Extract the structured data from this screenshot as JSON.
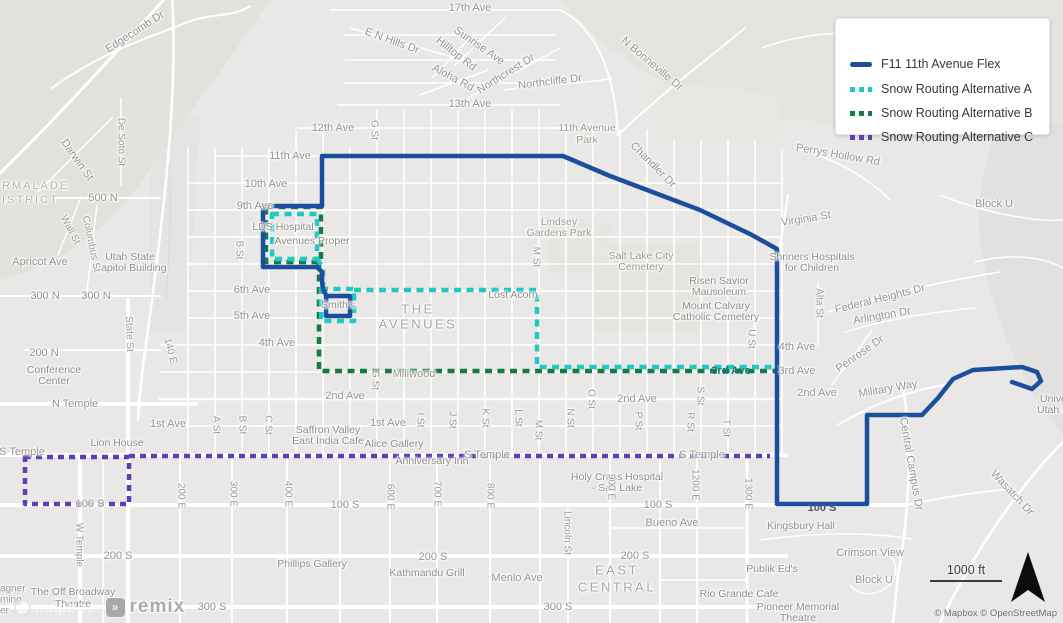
{
  "legend": {
    "items": [
      {
        "label": "F11 11th Avenue Flex",
        "color": "#1b4f9e",
        "style": "solid"
      },
      {
        "label": "Snow Routing Alternative A",
        "color": "#1fc8c2",
        "style": "dashed"
      },
      {
        "label": "Snow Routing Alternative B",
        "color": "#177a44",
        "style": "dashed"
      },
      {
        "label": "Snow Routing Alternative C",
        "color": "#5c3fb0",
        "style": "dashed"
      }
    ]
  },
  "scale_bar": {
    "label": "1000 ft"
  },
  "attribution": {
    "text": "© Mapbox © OpenStreetMap"
  },
  "watermark": {
    "mapbox": "mapbox",
    "remix": "remix",
    "remix_icon": "»"
  },
  "colors": {
    "route_f11": "#1b4f9e",
    "route_alt_a": "#1fc8c2",
    "route_alt_b": "#177a44",
    "route_alt_c": "#5c3fb0",
    "map_base": "#e9e8e6",
    "roads": "#ffffff"
  },
  "routes": [
    {
      "id": "alt-b",
      "name": "Snow Routing Alternative B",
      "color": "#177a44",
      "width": 4.5,
      "dash": "7 5.5",
      "paths": [
        "M266,207 L321,207 L321,262 L266,262 Z",
        "M319,262 L319,371 L775,371"
      ]
    },
    {
      "id": "alt-a",
      "name": "Snow Routing Alternative A",
      "color": "#1fc8c2",
      "width": 4.5,
      "dash": "7 5.5",
      "paths": [
        "M272,214 L317,214 L317,259 L272,259 Z",
        "M317,259 L323,267 L323,289",
        "M321,289 L354,289 L354,321 L321,321 Z",
        "M354,290 L537,290 L537,367 L775,367"
      ]
    },
    {
      "id": "alt-c",
      "name": "Snow Routing Alternative C",
      "color": "#5c3fb0",
      "width": 4.5,
      "dash": "6 5",
      "paths": [
        "M25,457 L129,457 L129,504 L25,504 Z",
        "M129,456 L770,456"
      ]
    },
    {
      "id": "f11",
      "name": "F11 11th Avenue Flex",
      "color": "#1b4f9e",
      "width": 4.5,
      "dash": null,
      "paths": [
        "M327,297 L323,289 L322,281 L322,272 L317,267 L263,267 L263,206 L322,206 L322,156 L563,156 L610,176 L700,210 L752,235 L777,249 L777,504 L867,504 L867,415 L922,415 L938,398 L953,379 L973,370 L1022,367 L1037,372 L1041,381 L1032,389 L1012,382",
        "M326,296 L350,296 L350,316 L326,316 Z"
      ]
    }
  ],
  "map": {
    "labels": [
      {
        "t": "RMALADE",
        "x": 2,
        "y": 186,
        "c": "area",
        "a": "l"
      },
      {
        "t": "ISTRICT",
        "x": 2,
        "y": 200,
        "c": "area",
        "a": "l"
      },
      {
        "t": "THE",
        "x": 418,
        "y": 309,
        "c": "bigarea"
      },
      {
        "t": "AVENUES",
        "x": 418,
        "y": 324,
        "c": "bigarea"
      },
      {
        "t": "EAST",
        "x": 617,
        "y": 570,
        "c": "bigarea"
      },
      {
        "t": "CENTRAL",
        "x": 617,
        "y": 587,
        "c": "bigarea"
      },
      {
        "t": "17th Ave",
        "x": 470,
        "y": 8
      },
      {
        "t": "13th Ave",
        "x": 470,
        "y": 104
      },
      {
        "t": "12th Ave",
        "x": 333,
        "y": 128
      },
      {
        "t": "11th Ave",
        "x": 290,
        "y": 156
      },
      {
        "t": "10th Ave",
        "x": 266,
        "y": 184
      },
      {
        "t": "9th Ave",
        "x": 255,
        "y": 206
      },
      {
        "t": "6th Ave",
        "x": 252,
        "y": 290
      },
      {
        "t": "5th Ave",
        "x": 252,
        "y": 316
      },
      {
        "t": "4th Ave",
        "x": 277,
        "y": 343
      },
      {
        "t": "4th Ave",
        "x": 797,
        "y": 347
      },
      {
        "t": "3rd Ave",
        "x": 797,
        "y": 371
      },
      {
        "t": "3rd Ave",
        "x": 731,
        "y": 371,
        "c": "routeteal"
      },
      {
        "t": "2nd Ave",
        "x": 345,
        "y": 396
      },
      {
        "t": "2nd Ave",
        "x": 637,
        "y": 399
      },
      {
        "t": "2nd Ave",
        "x": 817,
        "y": 393
      },
      {
        "t": "1st Ave",
        "x": 168,
        "y": 424
      },
      {
        "t": "1st Ave",
        "x": 388,
        "y": 423
      },
      {
        "t": "N Temple",
        "x": 75,
        "y": 404
      },
      {
        "t": "S Temple",
        "x": 22,
        "y": 452
      },
      {
        "t": "S Temple",
        "x": 487,
        "y": 455
      },
      {
        "t": "S Temple",
        "x": 702,
        "y": 455
      },
      {
        "t": "500 N",
        "x": 103,
        "y": 198
      },
      {
        "t": "300 N",
        "x": 45,
        "y": 296
      },
      {
        "t": "300 N",
        "x": 96,
        "y": 296
      },
      {
        "t": "200 N",
        "x": 44,
        "y": 353
      },
      {
        "t": "100 S",
        "x": 90,
        "y": 504
      },
      {
        "t": "100 S",
        "x": 345,
        "y": 505
      },
      {
        "t": "100 S",
        "x": 658,
        "y": 505
      },
      {
        "t": "100 S",
        "x": 822,
        "y": 508,
        "c": "routeblue"
      },
      {
        "t": "200 S",
        "x": 118,
        "y": 556
      },
      {
        "t": "200 S",
        "x": 433,
        "y": 557
      },
      {
        "t": "200 S",
        "x": 635,
        "y": 556
      },
      {
        "t": "300 S",
        "x": 212,
        "y": 607
      },
      {
        "t": "300 S",
        "x": 558,
        "y": 607
      },
      {
        "t": "Bueno Ave",
        "x": 672,
        "y": 523
      },
      {
        "t": "Menlo Ave",
        "x": 517,
        "y": 578
      },
      {
        "t": "Apricot Ave",
        "x": 40,
        "y": 262
      },
      {
        "t": "Millwood",
        "x": 414,
        "y": 374
      },
      {
        "t": "Lost Acorn",
        "x": 513,
        "y": 295,
        "c": "poi"
      },
      {
        "t": "Smith's",
        "x": 338,
        "y": 305,
        "c": "poi"
      },
      {
        "t": "LDS Hospital",
        "x": 283,
        "y": 227,
        "c": "poi"
      },
      {
        "t": "Avenues Proper",
        "x": 312,
        "y": 241,
        "c": "poi"
      },
      {
        "t": "Edgecomb Dr",
        "x": 135,
        "y": 32,
        "r": -33
      },
      {
        "t": "E N Hills Dr",
        "x": 392,
        "y": 41,
        "r": 20
      },
      {
        "t": "Sunrise Ave",
        "x": 479,
        "y": 46,
        "r": 35
      },
      {
        "t": "Hilltop Rd",
        "x": 456,
        "y": 54,
        "r": 38
      },
      {
        "t": "Aloha Rd",
        "x": 453,
        "y": 78,
        "r": 28
      },
      {
        "t": "Northcrest Dr",
        "x": 506,
        "y": 74,
        "r": -32
      },
      {
        "t": "Northcliffe Dr",
        "x": 550,
        "y": 82,
        "r": -7
      },
      {
        "t": "N Bonneville Dr",
        "x": 652,
        "y": 64,
        "r": 40
      },
      {
        "t": "Perrys Hollow Rd",
        "x": 838,
        "y": 155,
        "r": 10
      },
      {
        "t": "Chandler Dr",
        "x": 653,
        "y": 165,
        "r": 45
      },
      {
        "t": "Virginia St",
        "x": 806,
        "y": 219,
        "r": -9
      },
      {
        "t": "Block U",
        "x": 994,
        "y": 204
      },
      {
        "t": "Block U",
        "x": 874,
        "y": 580
      },
      {
        "t": "Crimson View",
        "x": 870,
        "y": 553
      },
      {
        "t": "11th Avenue",
        "x": 587,
        "y": 128,
        "c": "park"
      },
      {
        "t": "Park",
        "x": 587,
        "y": 140,
        "c": "park"
      },
      {
        "t": "Lindsey",
        "x": 559,
        "y": 222,
        "c": "park"
      },
      {
        "t": "Gardens Park",
        "x": 559,
        "y": 233,
        "c": "park"
      },
      {
        "t": "Salt Lake City",
        "x": 641,
        "y": 256,
        "c": "park"
      },
      {
        "t": "Cemetery",
        "x": 641,
        "y": 267,
        "c": "park"
      },
      {
        "t": "Risen Savior",
        "x": 719,
        "y": 281,
        "c": "poi"
      },
      {
        "t": "Mausoleum",
        "x": 719,
        "y": 292,
        "c": "poi"
      },
      {
        "t": "Mount Calvary",
        "x": 716,
        "y": 306,
        "c": "poi"
      },
      {
        "t": "Catholic Cemetery",
        "x": 716,
        "y": 317,
        "c": "poi"
      },
      {
        "t": "Shriners Hospitals",
        "x": 812,
        "y": 257,
        "c": "poi"
      },
      {
        "t": "for Children",
        "x": 812,
        "y": 268,
        "c": "poi"
      },
      {
        "t": "Federal Heights Dr",
        "x": 880,
        "y": 299,
        "r": -14
      },
      {
        "t": "Arlington Dr",
        "x": 882,
        "y": 316,
        "r": -10
      },
      {
        "t": "Alta St",
        "x": 819,
        "y": 303,
        "r": 90,
        "c": "vert"
      },
      {
        "t": "Penrose Dr",
        "x": 860,
        "y": 354,
        "r": -35
      },
      {
        "t": "Military Way",
        "x": 888,
        "y": 389,
        "r": -10
      },
      {
        "t": "Central Campus Dr",
        "x": 911,
        "y": 464,
        "r": 80
      },
      {
        "t": "Wasatch Dr",
        "x": 1012,
        "y": 493,
        "r": 47
      },
      {
        "t": "Kingsbury Hall",
        "x": 801,
        "y": 526,
        "c": "poi"
      },
      {
        "t": "Publik Ed's",
        "x": 772,
        "y": 569,
        "c": "poi"
      },
      {
        "t": "Rio Grande Cafe",
        "x": 739,
        "y": 594,
        "c": "poi"
      },
      {
        "t": "Pioneer Memorial",
        "x": 798,
        "y": 607,
        "c": "poi"
      },
      {
        "t": "Theatre",
        "x": 798,
        "y": 618,
        "c": "poi"
      },
      {
        "t": "Holy Cross Hospital",
        "x": 617,
        "y": 477,
        "c": "poi"
      },
      {
        "t": "- Salt Lake",
        "x": 617,
        "y": 488,
        "c": "poi"
      },
      {
        "t": "Anniversary Inn",
        "x": 432,
        "y": 461,
        "c": "poi"
      },
      {
        "t": "Alice Gallery",
        "x": 394,
        "y": 444,
        "c": "poi"
      },
      {
        "t": "Saffron Valley",
        "x": 328,
        "y": 430,
        "c": "poi"
      },
      {
        "t": "East India Cafe",
        "x": 328,
        "y": 441,
        "c": "poi"
      },
      {
        "t": "Lion House",
        "x": 117,
        "y": 443,
        "c": "poi"
      },
      {
        "t": "Conference",
        "x": 54,
        "y": 370,
        "c": "poi"
      },
      {
        "t": "Center",
        "x": 54,
        "y": 381,
        "c": "poi"
      },
      {
        "t": "Utah State",
        "x": 130,
        "y": 257,
        "c": "poi"
      },
      {
        "t": "Capitol Building",
        "x": 130,
        "y": 268,
        "c": "poi"
      },
      {
        "t": "The Off Broadway",
        "x": 73,
        "y": 592,
        "c": "poi"
      },
      {
        "t": "Theatre",
        "x": 73,
        "y": 604,
        "c": "poi"
      },
      {
        "t": "Phillips Gallery",
        "x": 312,
        "y": 564,
        "c": "poi"
      },
      {
        "t": "Kathmandu Grill",
        "x": 427,
        "y": 573,
        "c": "poi"
      },
      {
        "t": "agner",
        "x": 0,
        "y": 589,
        "c": "frag",
        "a": "l"
      },
      {
        "t": "ming",
        "x": 0,
        "y": 600,
        "c": "frag",
        "a": "l"
      },
      {
        "t": "er",
        "x": 0,
        "y": 611,
        "c": "frag",
        "a": "l"
      },
      {
        "t": "Univer",
        "x": 1040,
        "y": 399,
        "c": "poi",
        "a": "l"
      },
      {
        "t": "Utah H",
        "x": 1037,
        "y": 410,
        "c": "poi",
        "a": "l"
      },
      {
        "t": "De Soto St",
        "x": 121,
        "y": 142,
        "r": 90,
        "c": "vert"
      },
      {
        "t": "Darwin St",
        "x": 77,
        "y": 160,
        "r": 55
      },
      {
        "t": "Wall St",
        "x": 70,
        "y": 230,
        "r": 62,
        "c": "vert"
      },
      {
        "t": "Columbus St",
        "x": 91,
        "y": 244,
        "r": 78,
        "c": "vert"
      },
      {
        "t": "State St",
        "x": 129,
        "y": 334,
        "r": 88,
        "c": "vert"
      },
      {
        "t": "140 E",
        "x": 170,
        "y": 351,
        "r": 75,
        "c": "vert"
      },
      {
        "t": "W Temple",
        "x": 79,
        "y": 545,
        "r": 90,
        "c": "vert"
      },
      {
        "t": "A St",
        "x": 216,
        "y": 425,
        "r": 90,
        "c": "vert"
      },
      {
        "t": "B St",
        "x": 239,
        "y": 250,
        "r": 90,
        "c": "vert"
      },
      {
        "t": "B St",
        "x": 242,
        "y": 425,
        "r": 90,
        "c": "vert"
      },
      {
        "t": "C St",
        "x": 268,
        "y": 425,
        "r": 90,
        "c": "vert"
      },
      {
        "t": "G St",
        "x": 374,
        "y": 130,
        "r": 90,
        "c": "vert"
      },
      {
        "t": "G St",
        "x": 375,
        "y": 380,
        "r": 90,
        "c": "vert"
      },
      {
        "t": "I St",
        "x": 420,
        "y": 420,
        "r": 90,
        "c": "vert"
      },
      {
        "t": "J St",
        "x": 452,
        "y": 420,
        "r": 90,
        "c": "vert"
      },
      {
        "t": "K St",
        "x": 485,
        "y": 418,
        "r": 90,
        "c": "vert"
      },
      {
        "t": "L St",
        "x": 518,
        "y": 418,
        "r": 90,
        "c": "vert"
      },
      {
        "t": "M St",
        "x": 536,
        "y": 257,
        "r": 90,
        "c": "vert"
      },
      {
        "t": "M St",
        "x": 538,
        "y": 430,
        "r": 90,
        "c": "vert"
      },
      {
        "t": "N St",
        "x": 570,
        "y": 418,
        "r": 90,
        "c": "vert"
      },
      {
        "t": "O St",
        "x": 591,
        "y": 399,
        "r": 90,
        "c": "vert"
      },
      {
        "t": "P St",
        "x": 638,
        "y": 421,
        "r": 90,
        "c": "vert"
      },
      {
        "t": "R St",
        "x": 690,
        "y": 422,
        "r": 90,
        "c": "vert"
      },
      {
        "t": "S St",
        "x": 700,
        "y": 396,
        "r": 90,
        "c": "vert"
      },
      {
        "t": "T St",
        "x": 726,
        "y": 428,
        "r": 90,
        "c": "vert"
      },
      {
        "t": "U St",
        "x": 751,
        "y": 339,
        "r": 90,
        "c": "vert"
      },
      {
        "t": "200 E",
        "x": 181,
        "y": 496,
        "r": 90,
        "c": "vert"
      },
      {
        "t": "300 E",
        "x": 233,
        "y": 494,
        "r": 90,
        "c": "vert"
      },
      {
        "t": "400 E",
        "x": 288,
        "y": 494,
        "r": 90,
        "c": "vert"
      },
      {
        "t": "600 E",
        "x": 390,
        "y": 497,
        "r": 90,
        "c": "vert"
      },
      {
        "t": "700 E",
        "x": 437,
        "y": 494,
        "r": 90,
        "c": "vert"
      },
      {
        "t": "800 E",
        "x": 490,
        "y": 496,
        "r": 90,
        "c": "vert"
      },
      {
        "t": "900 E",
        "x": 611,
        "y": 487,
        "r": 90,
        "c": "vert"
      },
      {
        "t": "1200 E",
        "x": 695,
        "y": 485,
        "r": 90,
        "c": "vert"
      },
      {
        "t": "1300 E",
        "x": 748,
        "y": 494,
        "r": 90,
        "c": "vert"
      },
      {
        "t": "Lincoln St",
        "x": 567,
        "y": 533,
        "r": 90,
        "c": "vert"
      }
    ]
  }
}
